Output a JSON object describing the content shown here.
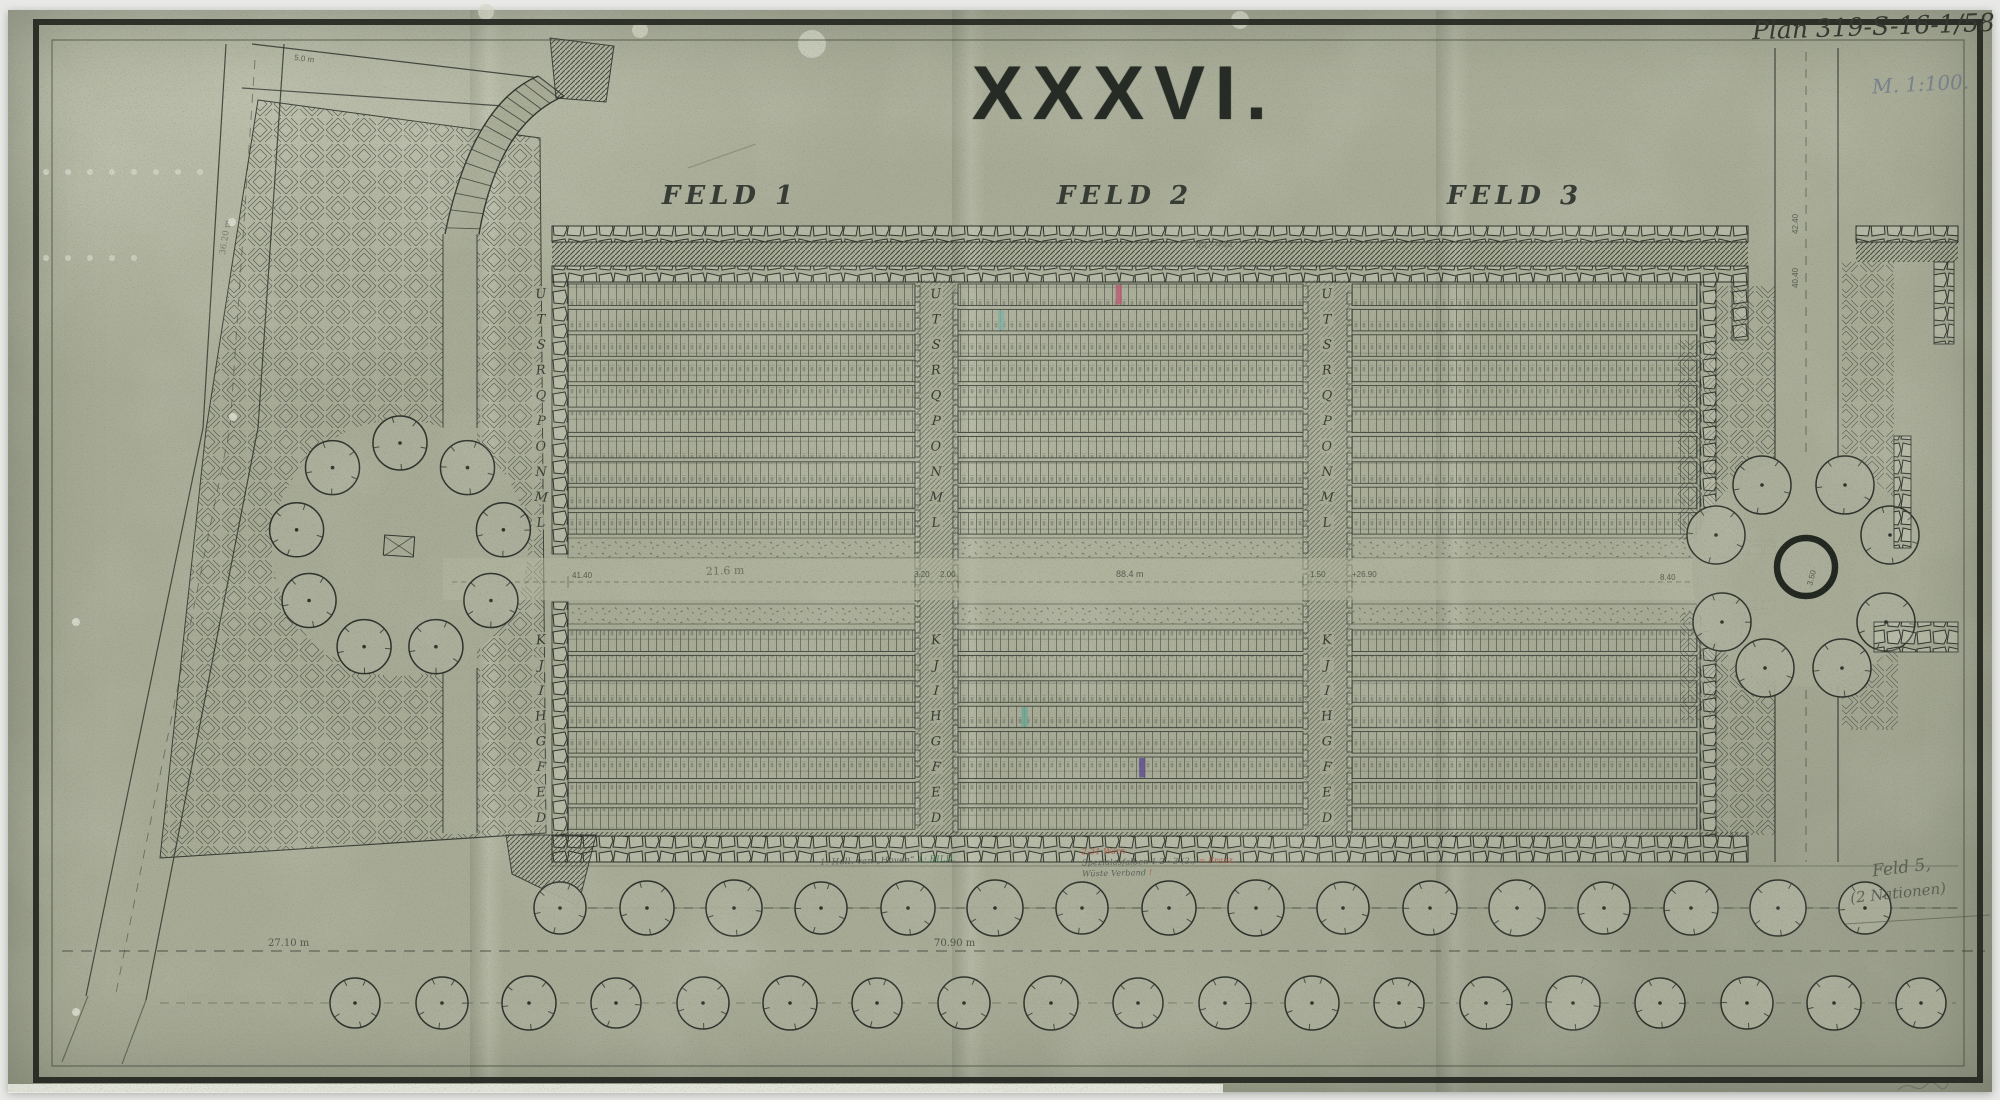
{
  "header": {
    "plan_number": "Plan 319-S-16-1/58",
    "scale_note": "M. 1:100.",
    "title": "XXXVI."
  },
  "fields": [
    {
      "label": "FELD 1",
      "cells_per_row": 44
    },
    {
      "label": "FELD 2",
      "cells_per_row": 44
    },
    {
      "label": "FELD 3",
      "cells_per_row": 43
    }
  ],
  "row_letters": {
    "upper": [
      "U",
      "T",
      "S",
      "R",
      "Q",
      "P",
      "O",
      "N",
      "M",
      "L"
    ],
    "lower": [
      "K",
      "J",
      "I",
      "H",
      "G",
      "F",
      "E",
      "D"
    ]
  },
  "marked_graves": [
    {
      "field": 1,
      "half": "upper",
      "row": "U",
      "cell": 20,
      "color": "#b95f74"
    },
    {
      "field": 1,
      "half": "upper",
      "row": "T",
      "cell": 5,
      "color": "#7fae9f"
    },
    {
      "field": 1,
      "half": "lower",
      "row": "H",
      "cell": 8,
      "color": "#6fa896"
    },
    {
      "field": 1,
      "half": "lower",
      "row": "F",
      "cell": 23,
      "color": "#5f4d91"
    }
  ],
  "dimensions": {
    "avenue_center": "70.90 m",
    "avenue_left": "27.10 m",
    "road_right_a": "42.40",
    "road_right_b": "40.40",
    "plaza_a": "8.40",
    "plaza_b": "6.40",
    "plaza_circle": "3.50",
    "mid_a": "41.40",
    "mid_b": "21.6 m",
    "mid_c": "3.20",
    "mid_d": "2.00",
    "mid_e": "88.4 m",
    "mid_f": "1.50",
    "mid_g": "+26.90",
    "top_left": "5.0 m",
    "diagonal": "36.20 m",
    "field3_pencil": "4a - 44a"
  },
  "annotations": {
    "bottom_center_a": [
      {
        "text": "1. Holl. van „Hoven“  ",
        "color": "#565b51"
      },
      {
        "text": "1: BILD.",
        "color": "#3f7a55"
      }
    ],
    "bottom_center_b": [
      [
        {
          "text": "2-31 Warn",
          "color": "#ad5240"
        }
      ],
      [
        {
          "text": "Spezialasfalben 1-2 · 3-(2.) ",
          "color": "#565b51"
        },
        {
          "text": "= Franz.",
          "color": "#ad5240"
        }
      ],
      [
        {
          "text": "Wüste  Verband ",
          "color": "#565b51"
        },
        {
          "text": "!",
          "color": "#ad5240"
        }
      ]
    ],
    "bottom_right_line1": "Feld 5,",
    "bottom_right_line2": "(2 Nationen)"
  },
  "site": {
    "avenue_row1_trees": 16,
    "avenue_row2_trees": 19,
    "left_grove_trees": 9,
    "right_plaza_trees": 8
  },
  "colors": {
    "paper": "#a7ab96",
    "ink": "#2c312a",
    "pencil": "#51564c",
    "blue_pencil": "#6d7888",
    "red_note": "#ad5240",
    "green_note": "#3f7a55"
  }
}
